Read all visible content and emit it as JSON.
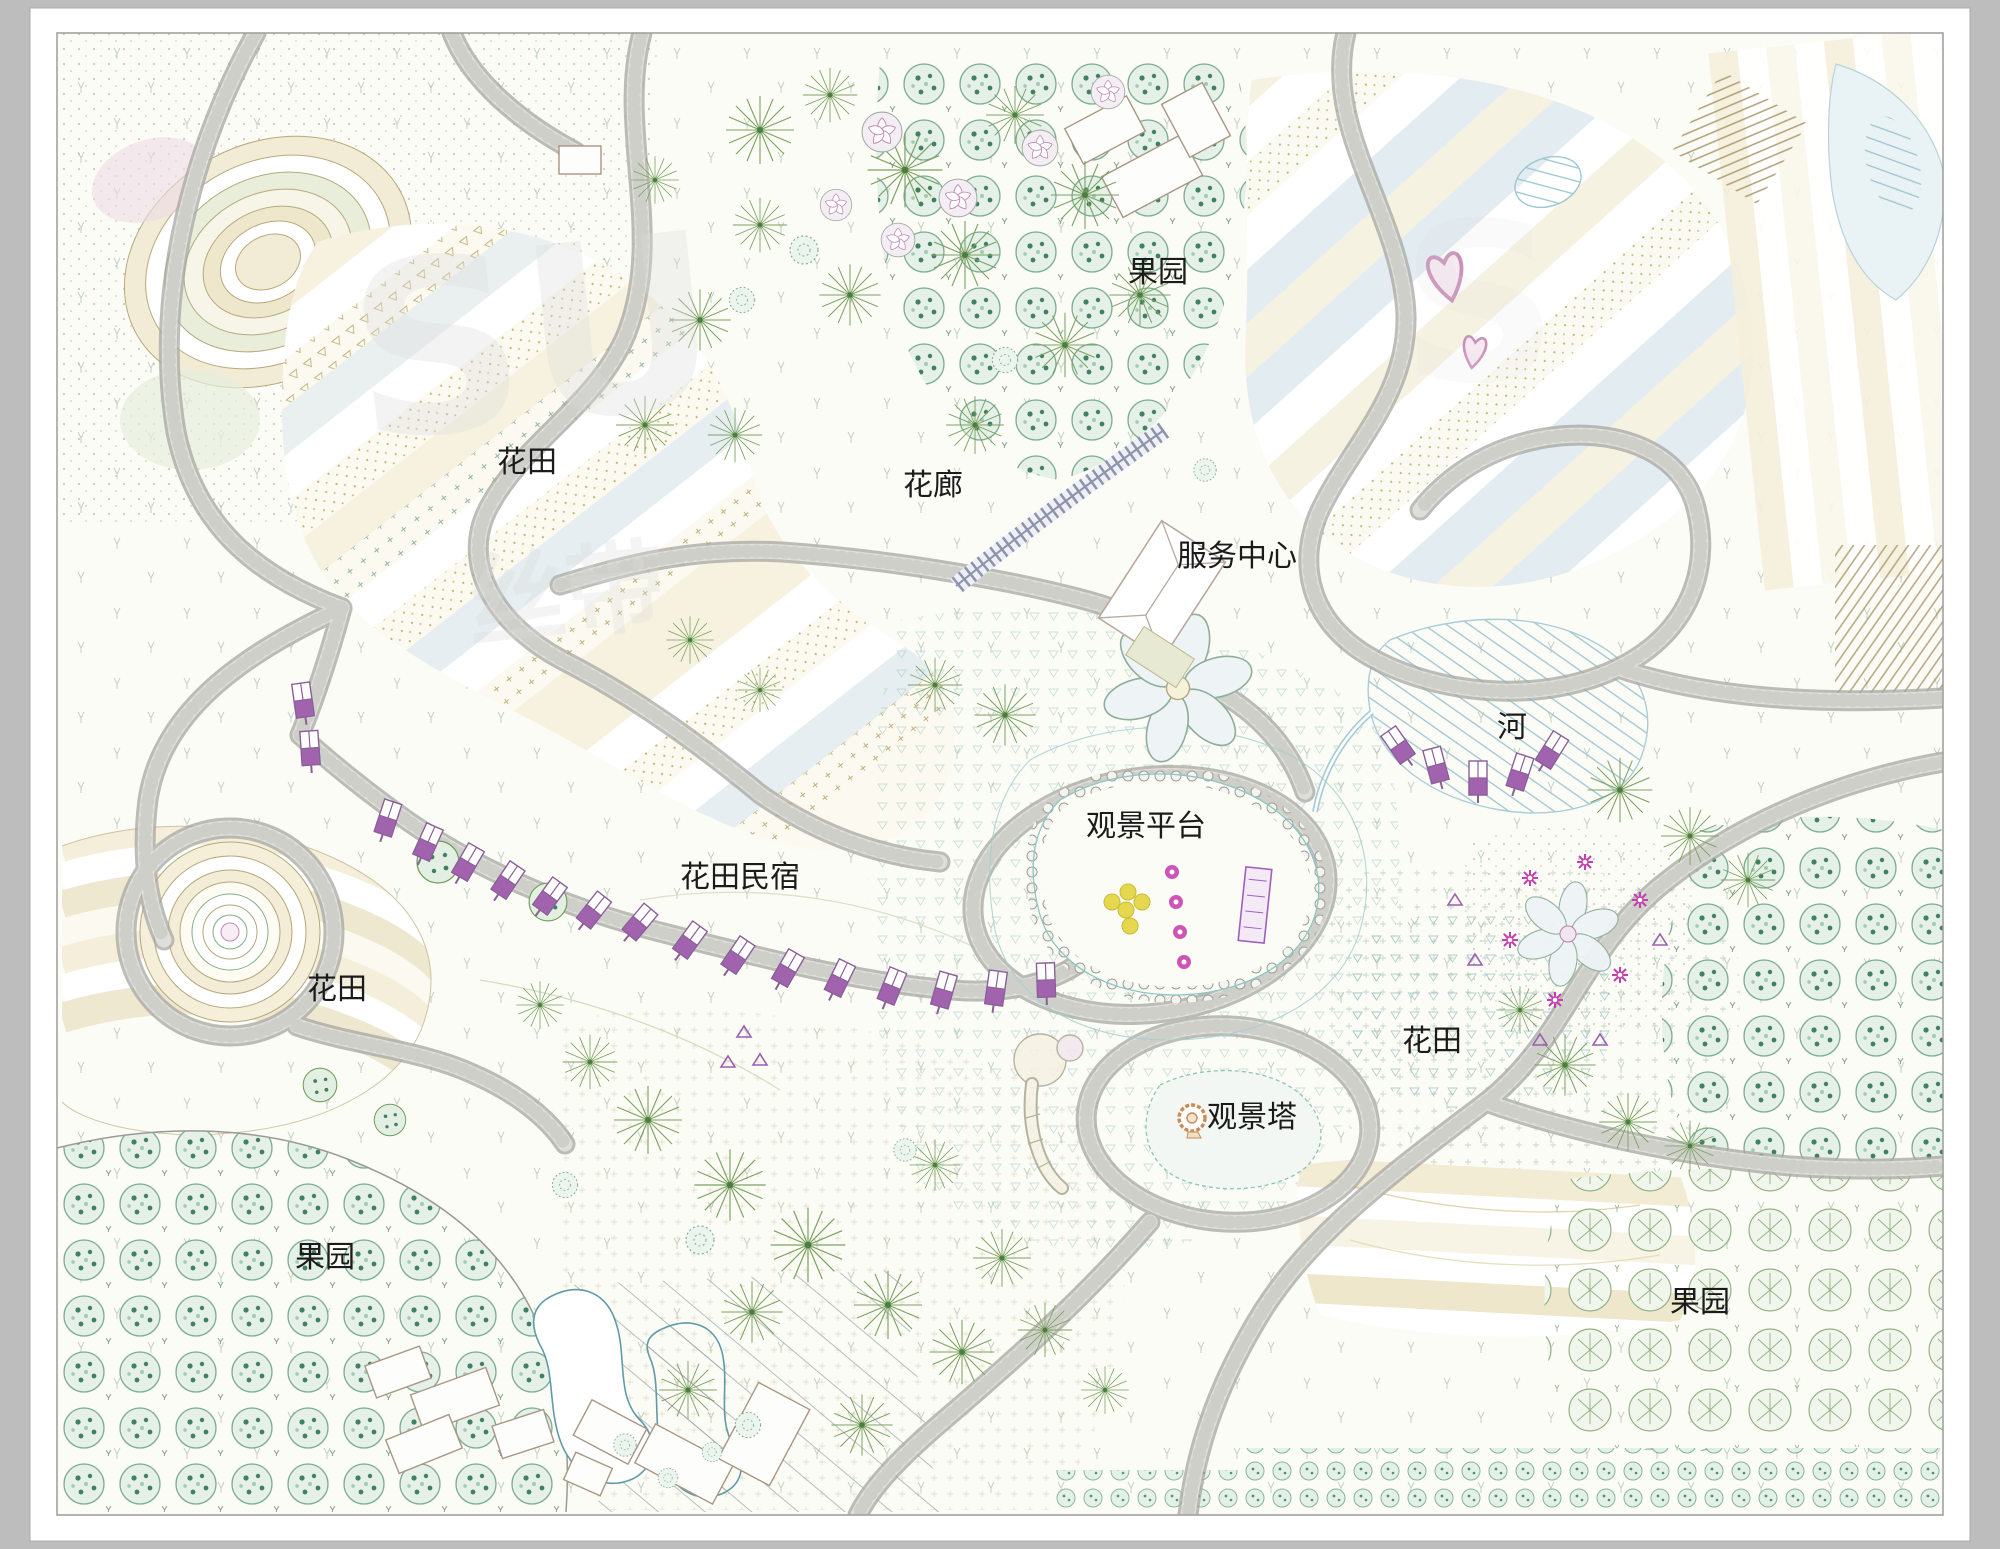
{
  "drawing": {
    "kind": "landscape-masterplan-site-plan",
    "style": "CAD colored plan with pattern fills"
  },
  "labels": [
    {
      "id": "orchard-top",
      "text": "果园"
    },
    {
      "id": "flower-field-upper",
      "text": "花田"
    },
    {
      "id": "flower-corridor",
      "text": "花廊"
    },
    {
      "id": "service-center",
      "text": "服务中心"
    },
    {
      "id": "river",
      "text": "河"
    },
    {
      "id": "viewing-platform",
      "text": "观景平台"
    },
    {
      "id": "homestay",
      "text": "花田民宿"
    },
    {
      "id": "flower-field-left",
      "text": "花田"
    },
    {
      "id": "flower-field-right",
      "text": "花田"
    },
    {
      "id": "viewing-tower",
      "text": "观景塔"
    },
    {
      "id": "orchard-bottom-left",
      "text": "果园"
    },
    {
      "id": "orchard-bottom-right",
      "text": "果园"
    }
  ],
  "watermarks": [
    "SU",
    "丝带",
    "S"
  ],
  "colors": {
    "frame_bg": "#bdbdbd",
    "mat": "#ffffff",
    "plan_bg": "#fcfcf6",
    "border": "#9b9b9b",
    "road_fill": "#dededb",
    "road_edge": "#a7a7a2",
    "label_color": "#1b1b1b",
    "watermark": "#d9d9d9",
    "tree_green": "#74a88c",
    "star_green": "#7aa25f",
    "orchard_speckle": "#41805f",
    "orchard_line": "#93b183",
    "water_blue": "#9fc6d4",
    "hut_purple": "#a263ae",
    "magenta": "#c33fb0",
    "heart_pink": "#c990b8",
    "tower_orange": "#cd8a52",
    "field_cream": "#f7f2e0",
    "field_olive": "#cdbd8f",
    "field_blue": "#e6eef1"
  }
}
